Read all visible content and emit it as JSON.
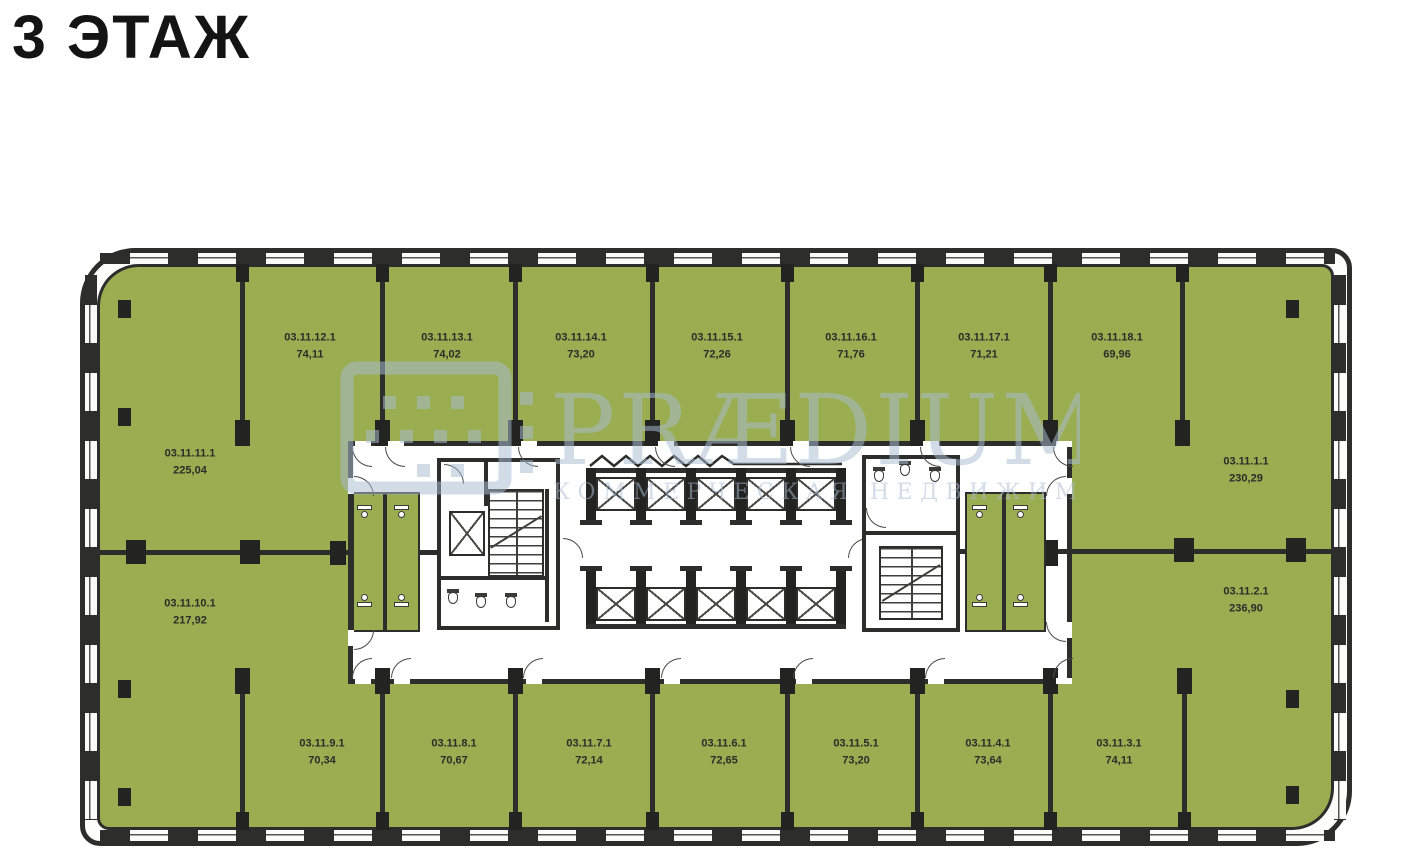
{
  "title": "3 ЭТАЖ",
  "watermark": {
    "brand": "PRÆDIUM",
    "subtitle": "КОММЕРЧЕСКАЯ НЕДВИЖИМОСТЬ"
  },
  "colors": {
    "room_fill": "#9aad50",
    "wall": "#2d2d2b",
    "watermark": "#a9bdd3"
  },
  "units": {
    "top_row": [
      {
        "id": "03.11.12.1",
        "area": "74,11"
      },
      {
        "id": "03.11.13.1",
        "area": "74,02"
      },
      {
        "id": "03.11.14.1",
        "area": "73,20"
      },
      {
        "id": "03.11.15.1",
        "area": "72,26"
      },
      {
        "id": "03.11.16.1",
        "area": "71,76"
      },
      {
        "id": "03.11.17.1",
        "area": "71,21"
      },
      {
        "id": "03.11.18.1",
        "area": "69,96"
      }
    ],
    "left_column": [
      {
        "id": "03.11.11.1",
        "area": "225,04"
      },
      {
        "id": "03.11.10.1",
        "area": "217,92"
      }
    ],
    "right_column": [
      {
        "id": "03.11.1.1",
        "area": "230,29"
      },
      {
        "id": "03.11.2.1",
        "area": "236,90"
      }
    ],
    "bottom_row": [
      {
        "id": "03.11.9.1",
        "area": "70,34"
      },
      {
        "id": "03.11.8.1",
        "area": "70,67"
      },
      {
        "id": "03.11.7.1",
        "area": "72,14"
      },
      {
        "id": "03.11.6.1",
        "area": "72,65"
      },
      {
        "id": "03.11.5.1",
        "area": "73,20"
      },
      {
        "id": "03.11.4.1",
        "area": "73,64"
      },
      {
        "id": "03.11.3.1",
        "area": "74,11"
      }
    ]
  }
}
